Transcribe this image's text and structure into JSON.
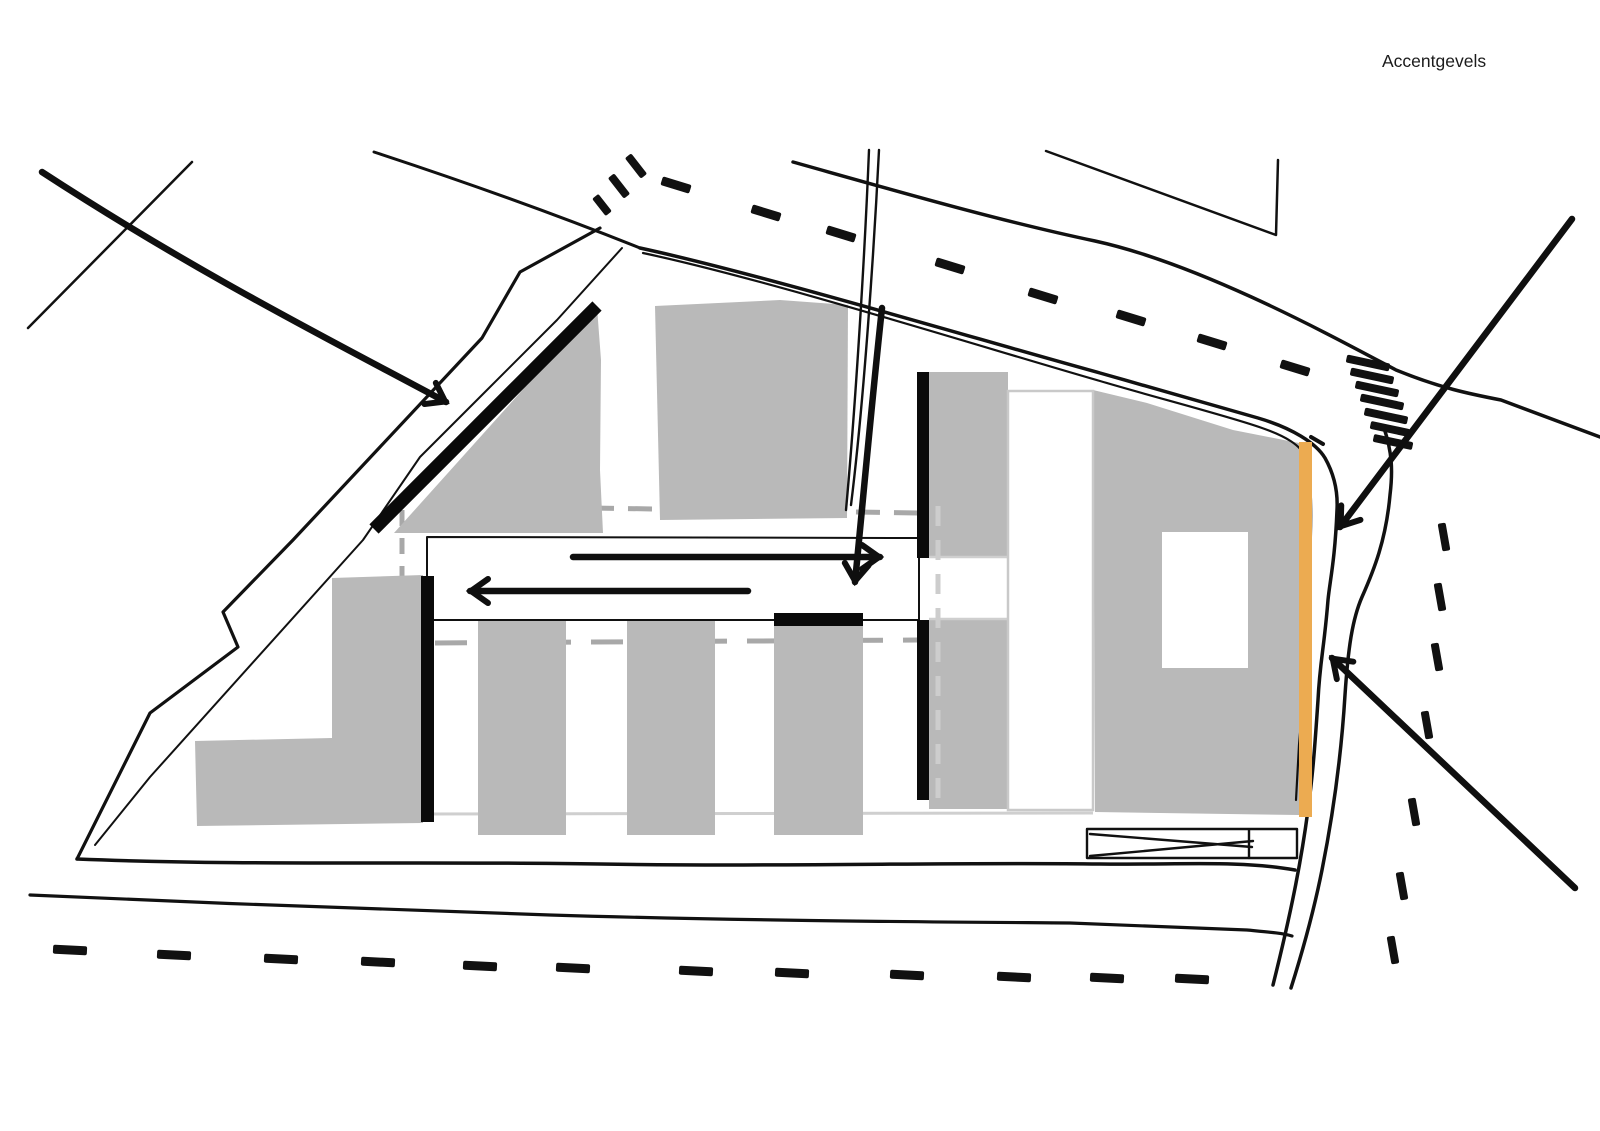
{
  "annotation": {
    "label": "Accentgevels"
  },
  "colors": {
    "accent_orange": "#ecab51",
    "accent_black": "#0a0a0a",
    "building_gray": "#b9b9b9",
    "parcel_line_light_gray": "#cfcfcf",
    "parcel_dash_gray": "#a8a8a8",
    "ink": "#111111",
    "background": "#ffffff"
  }
}
